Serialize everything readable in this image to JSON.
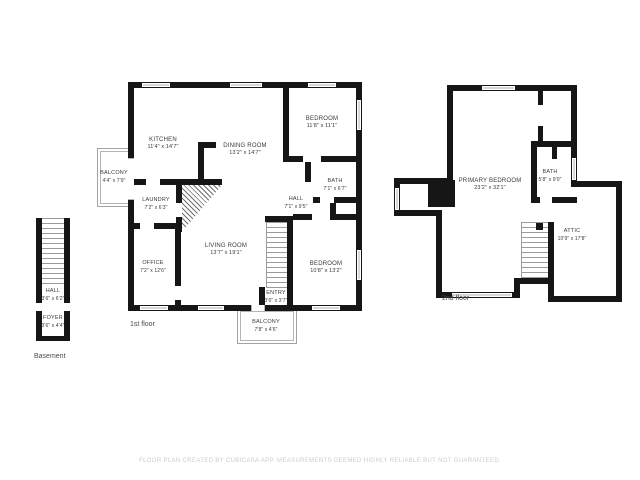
{
  "footer": {
    "disclaimer": "FLOOR PLAN CREATED BY CUBICASA APP. MEASUREMENTS DEEMED HIGHLY RELIABLE BUT NOT GUARANTEED."
  },
  "floors": {
    "basement": {
      "label": "Basement",
      "rooms": {
        "hall": {
          "name": "HALL",
          "dims": "3'6\" x 6'2\""
        },
        "foyer": {
          "name": "FOYER",
          "dims": "3'6\" x 4'4\""
        }
      }
    },
    "first": {
      "label": "1st floor",
      "rooms": {
        "kitchen": {
          "name": "KITCHEN",
          "dims": "11'4\" x 14'7\""
        },
        "dining": {
          "name": "DINING ROOM",
          "dims": "13'2\" x 14'7\""
        },
        "bedroom_top": {
          "name": "BEDROOM",
          "dims": "11'8\" x 11'1\""
        },
        "bath": {
          "name": "BATH",
          "dims": "7'1\" x 6'7\""
        },
        "hall": {
          "name": "HALL",
          "dims": "7'1\" x 9'5\""
        },
        "laundry": {
          "name": "LAUNDRY",
          "dims": "7'2\" x 6'3\""
        },
        "office": {
          "name": "OFFICE",
          "dims": "7'2\" x 12'6\""
        },
        "living": {
          "name": "LIVING ROOM",
          "dims": "13'7\" x 19'1\""
        },
        "bedroom_bottom": {
          "name": "BEDROOM",
          "dims": "10'8\" x 13'2\""
        },
        "entry": {
          "name": "ENTRY",
          "dims": "3'6\" x 3'7\""
        },
        "balcony_left": {
          "name": "BALCONY",
          "dims": "4'4\" x 7'9\""
        },
        "balcony_bottom": {
          "name": "BALCONY",
          "dims": "7'8\" x 4'6\""
        }
      }
    },
    "second": {
      "label": "2nd floor",
      "rooms": {
        "primary": {
          "name": "PRIMARY BEDROOM",
          "dims": "23'2\" x 32'1\""
        },
        "bath": {
          "name": "BATH",
          "dims": "5'8\" x 9'0\""
        },
        "attic": {
          "name": "ATTIC",
          "dims": "10'9\" x 17'8\""
        }
      }
    }
  }
}
